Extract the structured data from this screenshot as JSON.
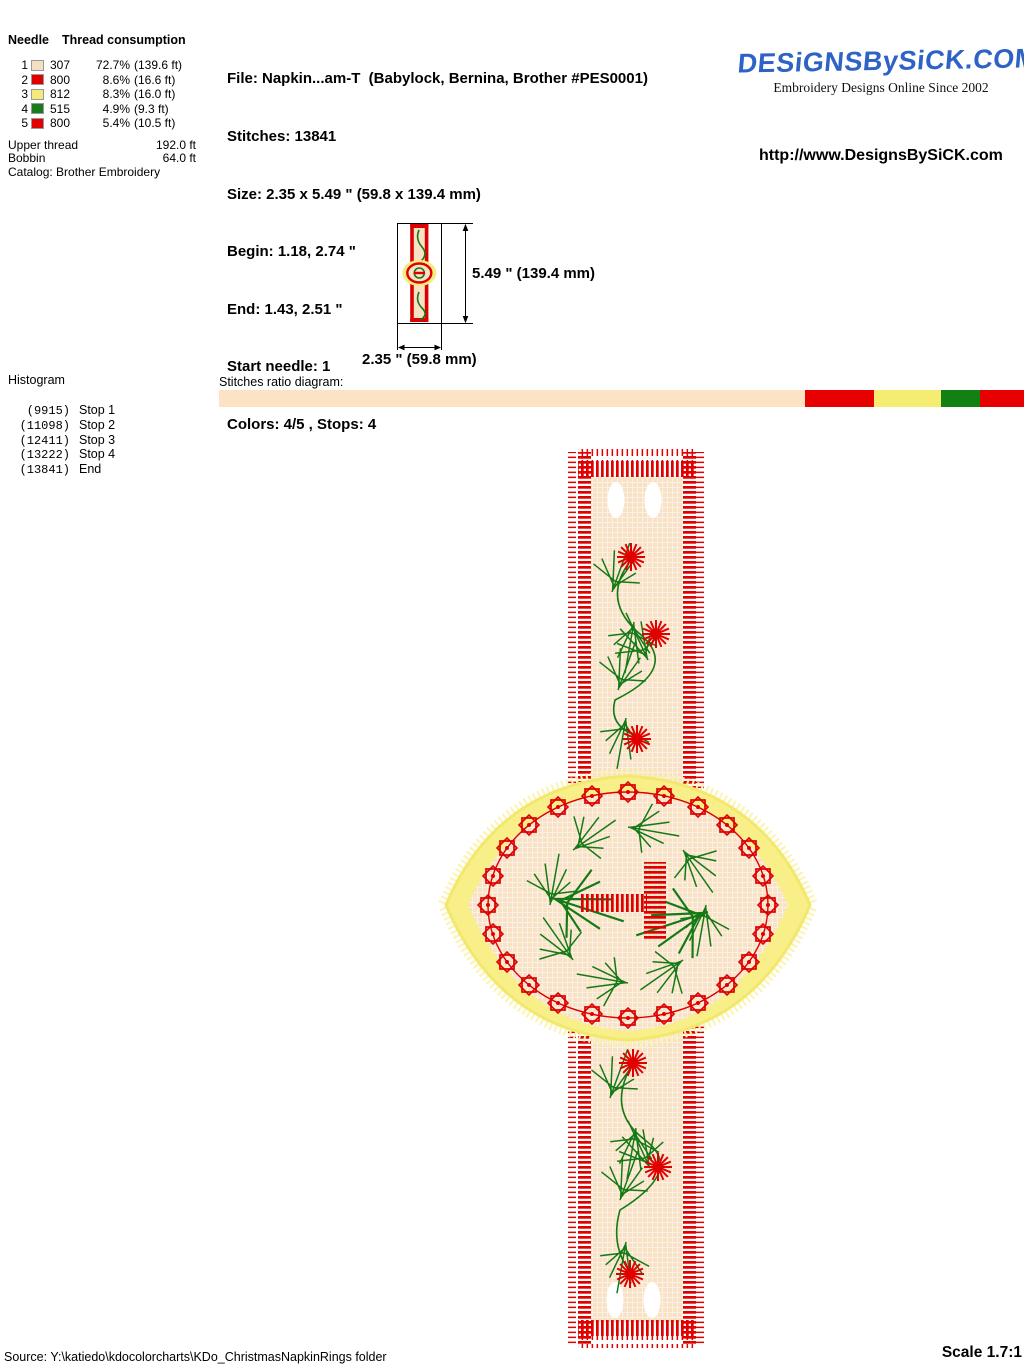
{
  "needle_table": {
    "col_needle": "Needle",
    "col_consumption": "Thread consumption",
    "rows": [
      {
        "needle": "1",
        "color": "#f5dfc2",
        "code": "307",
        "percent": "72.7%",
        "length": "(139.6 ft)"
      },
      {
        "needle": "2",
        "color": "#e00000",
        "code": "800",
        "percent": "8.6%",
        "length": "(16.6 ft)"
      },
      {
        "needle": "3",
        "color": "#f5e87d",
        "code": "812",
        "percent": "8.3%",
        "length": "(16.0 ft)"
      },
      {
        "needle": "4",
        "color": "#1b7a1b",
        "code": "515",
        "percent": "4.9%",
        "length": "(9.3 ft)"
      },
      {
        "needle": "5",
        "color": "#e00000",
        "code": "800",
        "percent": "5.4%",
        "length": "(10.5 ft)"
      }
    ],
    "upper_thread_label": "Upper thread",
    "upper_thread_value": "192.0 ft",
    "bobbin_label": "Bobbin",
    "bobbin_value": "64.0 ft",
    "catalog_line": "Catalog: Brother Embroidery"
  },
  "file_info": {
    "lines": [
      "File: Napkin...am-T  (Babylock, Bernina, Brother #PES0001)",
      "Stitches: 13841",
      "Size: 2.35 x 5.49 \" (59.8 x 139.4 mm)",
      "Begin: 1.18, 2.74 \"",
      "End: 1.43, 2.51 \"",
      "Start needle: 1",
      "Colors: 4/5 , Stops: 4"
    ]
  },
  "brand": {
    "logo": "DESiGNSBySiCK.COM",
    "tagline": "Embroidery Designs Online Since 2002",
    "url": "http://www.DesignsBySiCK.com"
  },
  "thumbnail": {
    "height_label": "5.49 \" (139.4 mm)",
    "width_label": "2.35 \" (59.8 mm)"
  },
  "histogram": {
    "title": "Histogram",
    "entries": [
      {
        "count": "(9915)",
        "label": "Stop 1"
      },
      {
        "count": "(11098)",
        "label": "Stop 2"
      },
      {
        "count": "(12411)",
        "label": "Stop 3"
      },
      {
        "count": "(13222)",
        "label": "Stop 4"
      },
      {
        "count": "(13841)",
        "label": "End"
      }
    ]
  },
  "ratio": {
    "label": "Stitches ratio diagram:",
    "segments": [
      {
        "color": "#fbe3c4",
        "pct": 72.7
      },
      {
        "color": "#e60000",
        "pct": 8.6
      },
      {
        "color": "#f5ec72",
        "pct": 8.3
      },
      {
        "color": "#128012",
        "pct": 4.9
      },
      {
        "color": "#e60000",
        "pct": 5.4
      }
    ]
  },
  "footer": {
    "source": "Source: Y:\\katiedo\\kdocolorcharts\\KDo_ChristmasNapkinRings folder",
    "scale": "Scale 1.7:1"
  }
}
